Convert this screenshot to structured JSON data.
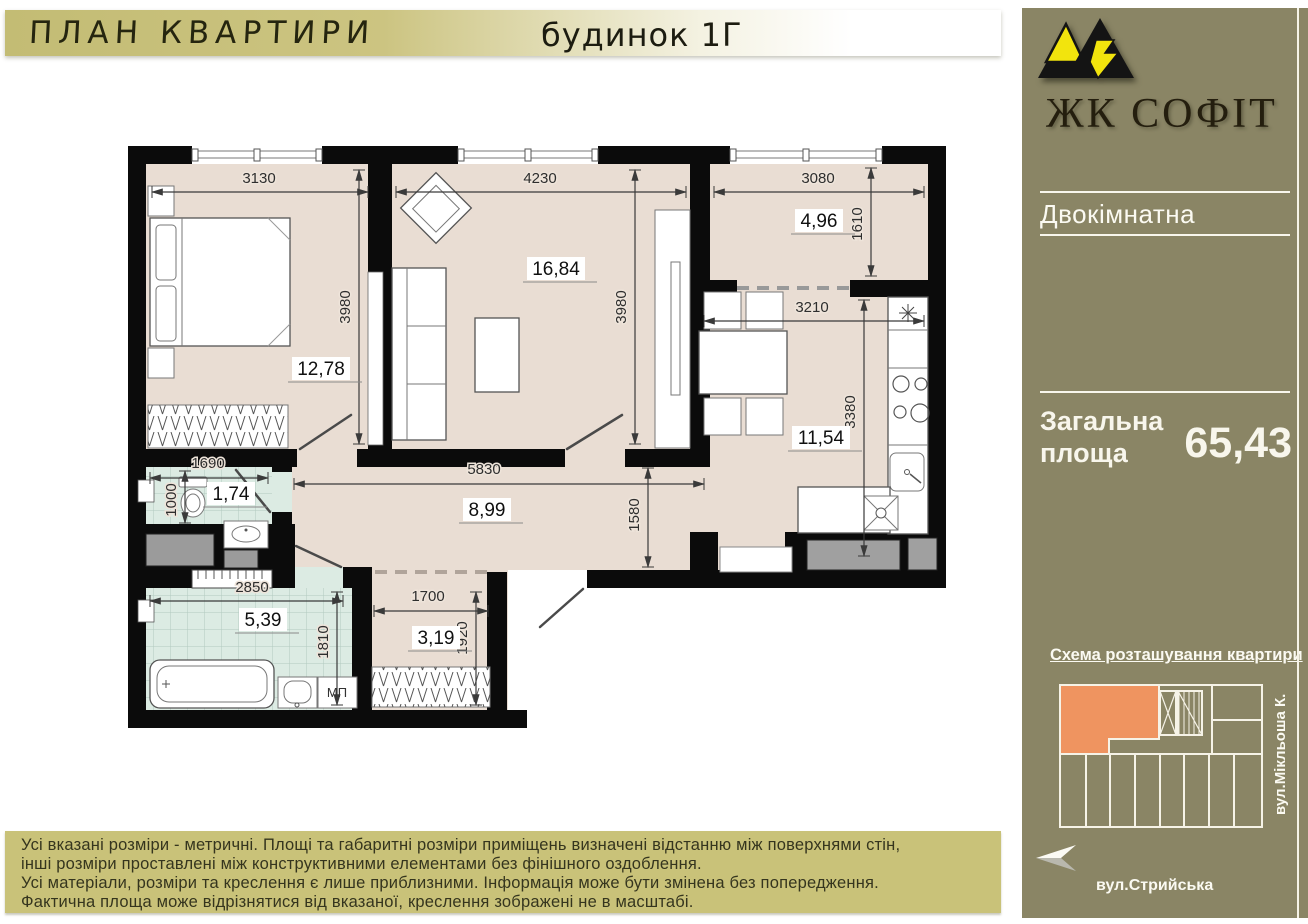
{
  "header": {
    "title": "ПЛАН КВАРТИРИ",
    "building": "будинок 1Г"
  },
  "sidebar": {
    "brand": "ЖК СОФІТ",
    "apartment_type": "Двокімнатна",
    "total_area_label_line1": "Загальна",
    "total_area_label_line2": "площа",
    "total_area_value": "65,43",
    "scheme_title": "Схема розташування квартири",
    "street_bottom": "вул.Стрийська",
    "street_right": "вул.Мікльоша К.",
    "colors": {
      "bg": "#8a8565",
      "highlight_orange": "#ef9460",
      "logo_yellow": "#f2e40d"
    }
  },
  "footer": {
    "lines": [
      "Усі вказані розміри - метричні. Площі та габаритні розміри приміщень визначені відстанню між  поверхнями стін,",
      "інші розміри проставлені між конструктивними елементами без фінішного оздоблення.",
      "Усі матеріали, розміри та креслення є лише приблизними. Інформація може бути змінена без попередження.",
      "Фактична площа може відрізнятися від вказаної, креслення зображені не в масштабі."
    ]
  },
  "plan": {
    "rooms": [
      {
        "name": "bedroom",
        "area": "12,78",
        "x": 321,
        "y": 372
      },
      {
        "name": "living-room",
        "area": "16,84",
        "x": 556,
        "y": 272
      },
      {
        "name": "balcony",
        "area": "4,96",
        "x": 819,
        "y": 224
      },
      {
        "name": "kitchen",
        "area": "11,54",
        "x": 821,
        "y": 441
      },
      {
        "name": "wc",
        "area": "1,74",
        "x": 231,
        "y": 497
      },
      {
        "name": "hallway",
        "area": "8,99",
        "x": 487,
        "y": 513
      },
      {
        "name": "bathroom",
        "area": "5,39",
        "x": 263,
        "y": 623
      },
      {
        "name": "entry",
        "area": "3,19",
        "x": 436,
        "y": 641
      }
    ],
    "dimensions": [
      {
        "text": "3130",
        "x": 259,
        "y": 183,
        "rot": 0,
        "line": [
          152,
          192,
          368,
          192
        ]
      },
      {
        "text": "4230",
        "x": 540,
        "y": 183,
        "rot": 0,
        "line": [
          396,
          192,
          686,
          192
        ]
      },
      {
        "text": "3080",
        "x": 818,
        "y": 183,
        "rot": 0,
        "line": [
          714,
          192,
          924,
          192
        ]
      },
      {
        "text": "1610",
        "x": 862,
        "y": 224,
        "rot": 90,
        "line": [
          871,
          168,
          871,
          276
        ]
      },
      {
        "text": "3980",
        "x": 350,
        "y": 307,
        "rot": 90,
        "line": [
          359,
          170,
          359,
          444
        ]
      },
      {
        "text": "3980",
        "x": 626,
        "y": 307,
        "rot": 90,
        "line": [
          635,
          170,
          635,
          444
        ]
      },
      {
        "text": "3210",
        "x": 812,
        "y": 312,
        "rot": 0,
        "line": [
          704,
          321,
          924,
          321
        ]
      },
      {
        "text": "3380",
        "x": 855,
        "y": 412,
        "rot": 90,
        "line": [
          864,
          300,
          864,
          556
        ]
      },
      {
        "text": "1690",
        "x": 208,
        "y": 468,
        "rot": 0,
        "line": [
          150,
          478,
          268,
          478
        ]
      },
      {
        "text": "1000",
        "x": 176,
        "y": 500,
        "rot": 90,
        "line": [
          185,
          471,
          185,
          523
        ]
      },
      {
        "text": "5830",
        "x": 484,
        "y": 474,
        "rot": 0,
        "line": [
          294,
          484,
          704,
          484
        ]
      },
      {
        "text": "1580",
        "x": 639,
        "y": 515,
        "rot": 90,
        "line": [
          648,
          468,
          648,
          567
        ]
      },
      {
        "text": "2850",
        "x": 252,
        "y": 592,
        "rot": 0,
        "line": [
          150,
          601,
          343,
          601
        ]
      },
      {
        "text": "1810",
        "x": 328,
        "y": 642,
        "rot": 90,
        "line": [
          337,
          592,
          337,
          705
        ]
      },
      {
        "text": "1700",
        "x": 428,
        "y": 601,
        "rot": 0,
        "line": [
          374,
          611,
          488,
          611
        ]
      },
      {
        "text": "1920",
        "x": 467,
        "y": 638,
        "rot": 90,
        "line": [
          476,
          592,
          476,
          705
        ]
      }
    ],
    "fixtures": [
      {
        "name": "washing-machine-label",
        "text": "МП",
        "x": 337,
        "y": 697
      }
    ]
  }
}
